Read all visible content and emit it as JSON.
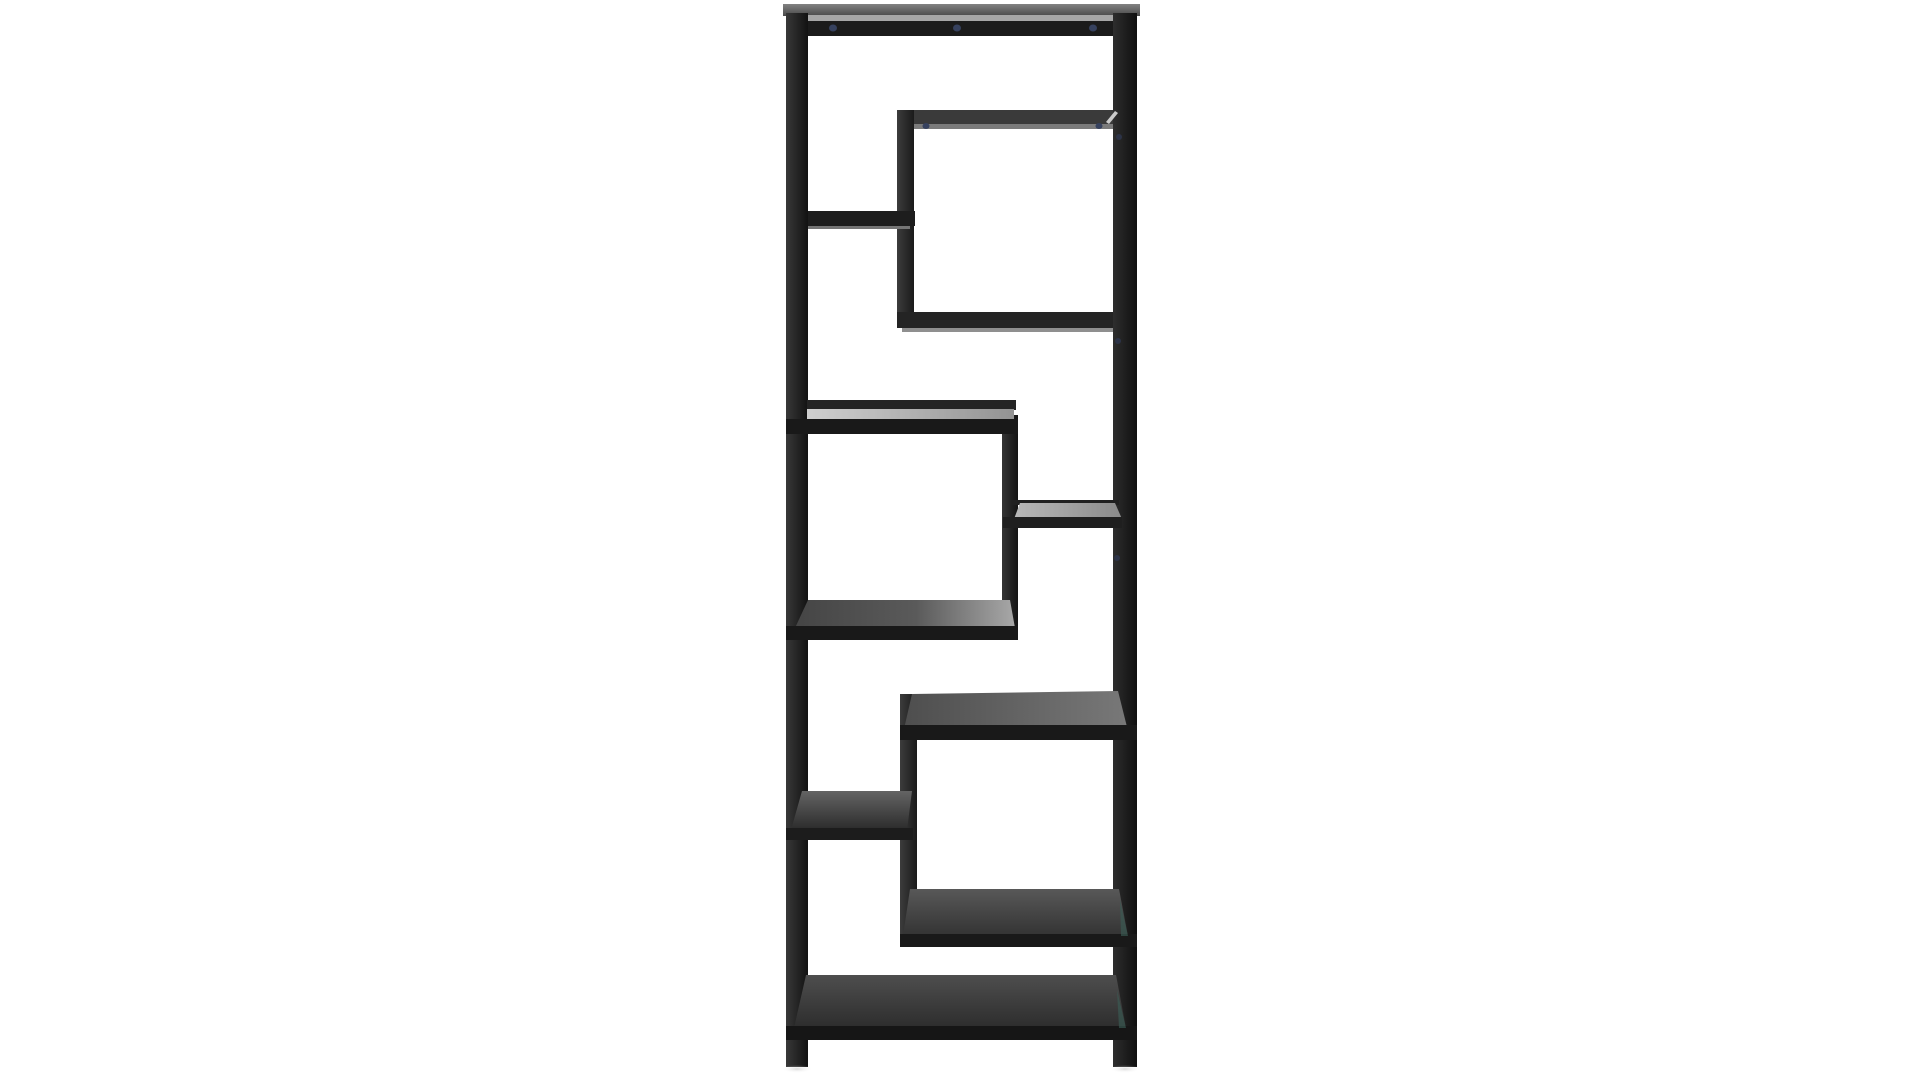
{
  "scene": {
    "description": "Product photo: tall black metal shelving unit (etagere) with eight staggered smoked-glass shelves in an asymmetric zigzag arrangement, photographed on a plain white background",
    "background": "#ffffff",
    "image": {
      "width": 1920,
      "height": 1080
    },
    "palette": {
      "metal_black": "#1b1b1b",
      "metal_dark_gray": "#3a3a3a",
      "glass_light": "#c9c9c9",
      "glass_dark": "#2e2e2e",
      "reflection_strip": "#a6a6a6",
      "screw_blue": "#36415e",
      "glass_edge_teal": "#3a5c55",
      "shadow": "#bbbbbb"
    },
    "gradients": [
      {
        "id": "gPostL",
        "dir": "h",
        "stops": [
          [
            0,
            "#383838"
          ],
          [
            1,
            "#121212"
          ]
        ]
      },
      {
        "id": "gPostR",
        "dir": "h",
        "stops": [
          [
            0,
            "#2e2e2e"
          ],
          [
            1,
            "#0f0f0f"
          ]
        ]
      },
      {
        "id": "gTopSurf",
        "dir": "v",
        "stops": [
          [
            0,
            "#828282"
          ],
          [
            1,
            "#4a4a4a"
          ]
        ]
      },
      {
        "id": "gVert",
        "dir": "h",
        "stops": [
          [
            0,
            "#3c3c3c"
          ],
          [
            1,
            "#1a1a1a"
          ]
        ]
      },
      {
        "id": "gLeg",
        "dir": "h",
        "stops": [
          [
            0,
            "#343434"
          ],
          [
            1,
            "#141414"
          ]
        ]
      },
      {
        "id": "gGlassB",
        "dir": "h",
        "stops": [
          [
            0,
            "#cfcfcf"
          ],
          [
            1,
            "#939393"
          ]
        ]
      },
      {
        "id": "gGlassC",
        "dir": "h",
        "stops": [
          [
            0,
            "#b8b8b8"
          ],
          [
            1,
            "#8a8a8a"
          ]
        ]
      },
      {
        "id": "gGlassD",
        "dir": "h",
        "stops": [
          [
            0,
            "#454545"
          ],
          [
            0.55,
            "#5a5a5a"
          ],
          [
            1,
            "#a8a8a8"
          ]
        ]
      },
      {
        "id": "gGlassE",
        "dir": "h",
        "stops": [
          [
            0,
            "#4e4e4e"
          ],
          [
            1,
            "#787878"
          ]
        ]
      },
      {
        "id": "gGlassF",
        "dir": "v",
        "stops": [
          [
            0,
            "#646464"
          ],
          [
            1,
            "#2b2b2b"
          ]
        ]
      },
      {
        "id": "gGlassLB",
        "dir": "v",
        "stops": [
          [
            0,
            "#585858"
          ],
          [
            1,
            "#333333"
          ]
        ]
      },
      {
        "id": "gGlassG",
        "dir": "v",
        "stops": [
          [
            0,
            "#4e4e4e"
          ],
          [
            1,
            "#2d2d2d"
          ]
        ]
      },
      {
        "id": "gShadow",
        "dir": "r",
        "stops": [
          [
            0,
            "#b5b5b5"
          ],
          [
            1,
            "#ffffff"
          ]
        ]
      }
    ],
    "elements": [
      {
        "name": "top-surface",
        "type": "rect",
        "x": 783,
        "y": 4,
        "w": 357,
        "h": 12,
        "fill": "grad:gTopSurf"
      },
      {
        "name": "top-glass-strip",
        "type": "rect",
        "x": 789,
        "y": 15,
        "w": 346,
        "h": 7,
        "fill": "#a6a6a6"
      },
      {
        "name": "top-apron-bar",
        "type": "rect",
        "x": 786,
        "y": 21,
        "w": 351,
        "h": 15,
        "fill": "#1b1b1b"
      },
      {
        "name": "upper-box-top-bar",
        "type": "rect",
        "x": 897,
        "y": 110,
        "w": 240,
        "h": 14,
        "fill": "#3a3a3a"
      },
      {
        "name": "upper-box-top-strip",
        "type": "rect",
        "x": 902,
        "y": 124,
        "w": 230,
        "h": 5,
        "fill": "#7b7b7b"
      },
      {
        "name": "upper-box-left-upright",
        "type": "rect",
        "x": 897,
        "y": 110,
        "w": 17,
        "h": 218,
        "fill": "grad:gVert"
      },
      {
        "name": "upper-box-bottom-bar",
        "type": "rect",
        "x": 897,
        "y": 312,
        "w": 240,
        "h": 16,
        "fill": "#242424"
      },
      {
        "name": "upper-box-bottom-strip",
        "type": "rect",
        "x": 902,
        "y": 328,
        "w": 228,
        "h": 4,
        "fill": "#8f8f8f"
      },
      {
        "name": "shelf-a-bar",
        "type": "rect",
        "x": 786,
        "y": 211,
        "w": 129,
        "h": 15,
        "fill": "#1d1d1d"
      },
      {
        "name": "shelf-a-strip",
        "type": "rect",
        "x": 792,
        "y": 226,
        "w": 118,
        "h": 3,
        "fill": "#757575"
      },
      {
        "name": "left-post",
        "type": "rect",
        "x": 786,
        "y": 13,
        "w": 22,
        "h": 1054,
        "fill": "grad:gPostL"
      },
      {
        "name": "right-post",
        "type": "rect",
        "x": 1113,
        "y": 13,
        "w": 24,
        "h": 1054,
        "fill": "grad:gPostR"
      },
      {
        "name": "middle-leg",
        "type": "rect",
        "x": 1002,
        "y": 415,
        "w": 16,
        "h": 223,
        "fill": "grad:gLeg"
      },
      {
        "name": "shelf-b-back-rail",
        "type": "rect",
        "x": 807,
        "y": 400,
        "w": 209,
        "h": 10,
        "fill": "#242424"
      },
      {
        "name": "shelf-b-glass",
        "type": "rect",
        "x": 807,
        "y": 409,
        "w": 207,
        "h": 11,
        "fill": "grad:gGlassB"
      },
      {
        "name": "shelf-b-front-bar",
        "type": "rect",
        "x": 786,
        "y": 419,
        "w": 232,
        "h": 15,
        "fill": "#191919"
      },
      {
        "name": "shelf-c-back-rail",
        "type": "rect",
        "x": 1012,
        "y": 500,
        "w": 107,
        "h": 5,
        "fill": "#202020"
      },
      {
        "name": "shelf-c-glass",
        "type": "polygon",
        "points": [
          [
            1020,
            503
          ],
          [
            1115,
            503
          ],
          [
            1122,
            519
          ],
          [
            1014,
            519
          ]
        ],
        "fill": "grad:gGlassC"
      },
      {
        "name": "shelf-c-front-bar",
        "type": "rect",
        "x": 1003,
        "y": 517,
        "w": 119,
        "h": 11,
        "fill": "#1f1f1f"
      },
      {
        "name": "shelf-d-glass",
        "type": "polygon",
        "points": [
          [
            808,
            600
          ],
          [
            1010,
            600
          ],
          [
            1015,
            628
          ],
          [
            795,
            628
          ]
        ],
        "fill": "grad:gGlassD"
      },
      {
        "name": "shelf-d-front-bar",
        "type": "rect",
        "x": 786,
        "y": 626,
        "w": 232,
        "h": 14,
        "fill": "#191919"
      },
      {
        "name": "lower-box-left-upright",
        "type": "rect",
        "x": 900,
        "y": 694,
        "w": 17,
        "h": 253,
        "fill": "grad:gVert"
      },
      {
        "name": "lower-box-top-glass",
        "type": "polygon",
        "points": [
          [
            912,
            694
          ],
          [
            1118,
            691
          ],
          [
            1127,
            727
          ],
          [
            904,
            729
          ]
        ],
        "fill": "grad:gGlassE"
      },
      {
        "name": "lower-box-top-front-bar",
        "type": "rect",
        "x": 900,
        "y": 725,
        "w": 237,
        "h": 15,
        "fill": "#191919"
      },
      {
        "name": "shelf-f-glass",
        "type": "polygon",
        "points": [
          [
            802,
            791
          ],
          [
            912,
            791
          ],
          [
            907,
            830
          ],
          [
            791,
            830
          ]
        ],
        "fill": "grad:gGlassF"
      },
      {
        "name": "shelf-f-front-bar",
        "type": "rect",
        "x": 786,
        "y": 828,
        "w": 127,
        "h": 12,
        "fill": "#1c1c1c"
      },
      {
        "name": "lower-box-bottom-glass",
        "type": "polygon",
        "points": [
          [
            910,
            889
          ],
          [
            1119,
            889
          ],
          [
            1128,
            936
          ],
          [
            903,
            936
          ]
        ],
        "fill": "grad:gGlassLB"
      },
      {
        "name": "lower-box-bottom-front-bar",
        "type": "rect",
        "x": 900,
        "y": 934,
        "w": 237,
        "h": 13,
        "fill": "#191919"
      },
      {
        "name": "glass-edge-tint-lower-box",
        "type": "polygon",
        "points": [
          [
            1120,
            900
          ],
          [
            1128,
            936
          ],
          [
            1121,
            936
          ]
        ],
        "fill": "#3a5c55",
        "opacity": 0.65
      },
      {
        "name": "shelf-g-glass",
        "type": "polygon",
        "points": [
          [
            806,
            975
          ],
          [
            1116,
            975
          ],
          [
            1126,
            1028
          ],
          [
            794,
            1028
          ]
        ],
        "fill": "grad:gGlassG"
      },
      {
        "name": "shelf-g-front-bar",
        "type": "rect",
        "x": 786,
        "y": 1026,
        "w": 351,
        "h": 14,
        "fill": "#161616"
      },
      {
        "name": "glass-edge-tint-shelf-g",
        "type": "polygon",
        "points": [
          [
            1117,
            990
          ],
          [
            1126,
            1028
          ],
          [
            1119,
            1028
          ]
        ],
        "fill": "#3a5c55",
        "opacity": 0.65
      },
      {
        "name": "miter-highlight",
        "type": "polygon",
        "points": [
          [
            1106,
            122
          ],
          [
            1115,
            111
          ],
          [
            1118,
            113
          ],
          [
            1109,
            124
          ]
        ],
        "fill": "#dcdcdc",
        "opacity": 0.9
      },
      {
        "name": "screw-top-1",
        "type": "ellipse",
        "cx": 833,
        "cy": 28,
        "rx": 4,
        "ry": 3.5,
        "fill": "#36415e"
      },
      {
        "name": "screw-top-2",
        "type": "ellipse",
        "cx": 957,
        "cy": 28,
        "rx": 4,
        "ry": 3.5,
        "fill": "#36415e"
      },
      {
        "name": "screw-top-3",
        "type": "ellipse",
        "cx": 1093,
        "cy": 28,
        "rx": 4,
        "ry": 3.5,
        "fill": "#36415e"
      },
      {
        "name": "screw-upper-box-1",
        "type": "ellipse",
        "cx": 926,
        "cy": 126,
        "rx": 3.5,
        "ry": 3,
        "fill": "#36415e"
      },
      {
        "name": "screw-upper-box-2",
        "type": "ellipse",
        "cx": 1099,
        "cy": 126,
        "rx": 3.5,
        "ry": 3,
        "fill": "#36415e"
      },
      {
        "name": "screw-right-post-1",
        "type": "ellipse",
        "cx": 1119,
        "cy": 137,
        "rx": 3,
        "ry": 3,
        "fill": "#2c3347"
      },
      {
        "name": "screw-right-post-2",
        "type": "ellipse",
        "cx": 1118,
        "cy": 341,
        "rx": 3,
        "ry": 3,
        "fill": "#2c3347"
      },
      {
        "name": "screw-right-post-3",
        "type": "ellipse",
        "cx": 1117,
        "cy": 558,
        "rx": 3,
        "ry": 3,
        "fill": "#2c3347"
      },
      {
        "name": "foot-shadow-left",
        "type": "ellipse",
        "cx": 797,
        "cy": 1069,
        "rx": 16,
        "ry": 4,
        "fill": "grad:gShadow",
        "opacity": 0.5
      },
      {
        "name": "foot-shadow-right",
        "type": "ellipse",
        "cx": 1125,
        "cy": 1069,
        "rx": 16,
        "ry": 4,
        "fill": "grad:gShadow",
        "opacity": 0.5
      }
    ]
  }
}
